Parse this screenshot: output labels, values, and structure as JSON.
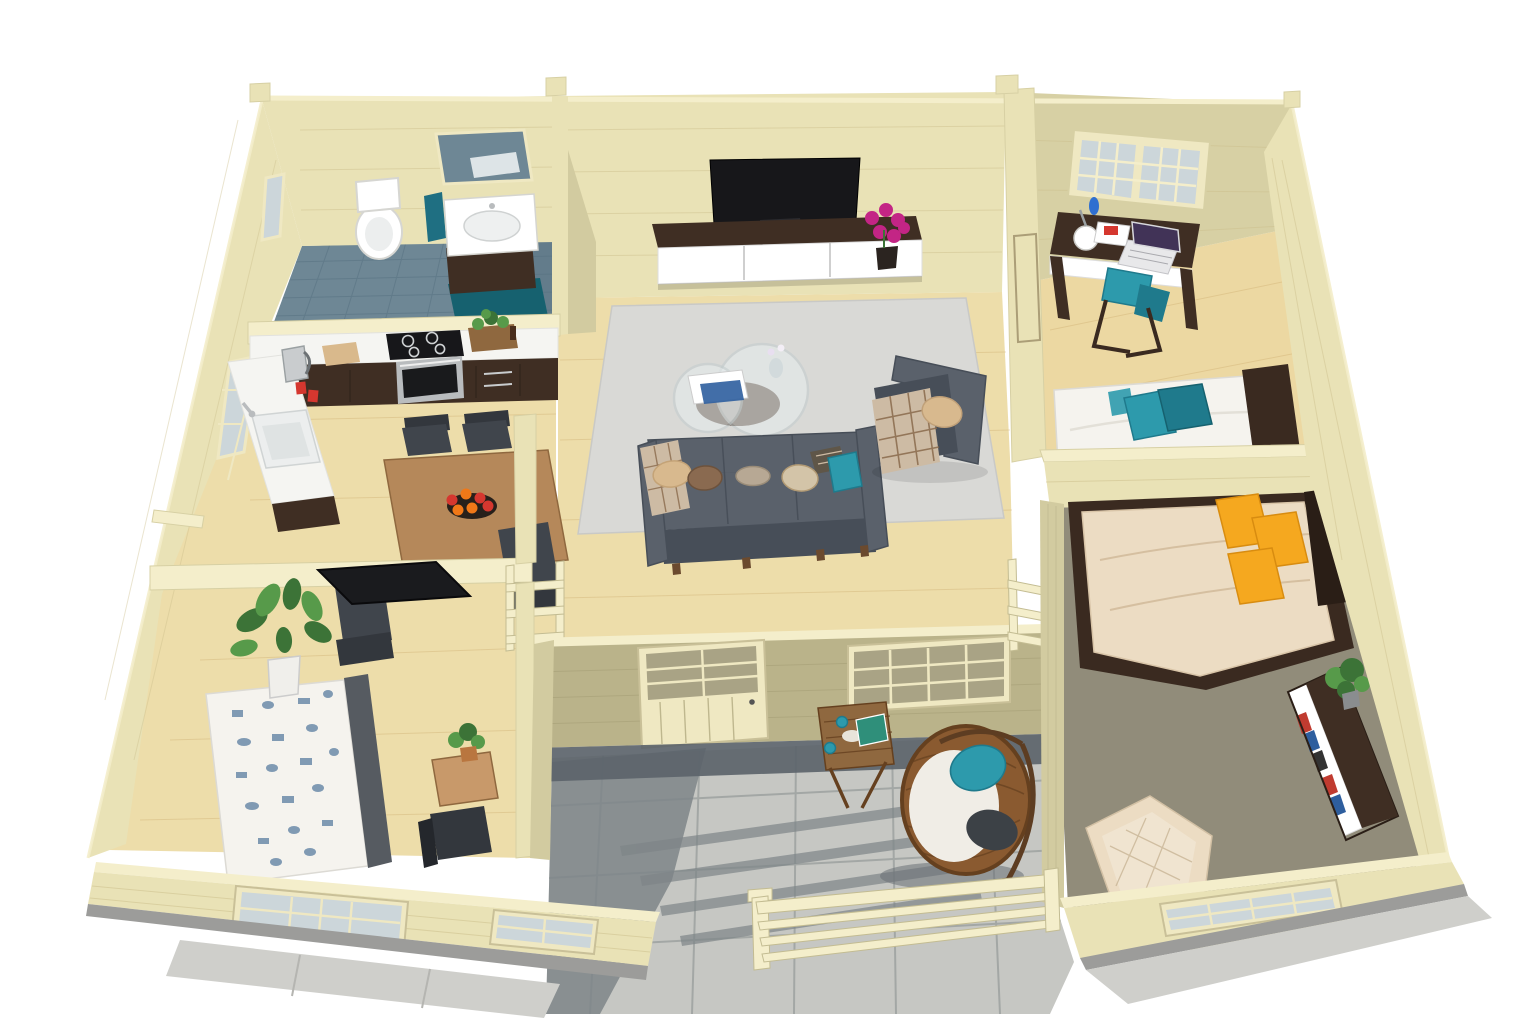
{
  "meta": {
    "title": "Log cabin interior — 3D bird's-eye floor-plan rendering",
    "view": "isometric top-down architectural visualization",
    "background": "#ffffff",
    "visible_text": "none"
  },
  "palette": {
    "bg": "#ffffff",
    "wall": "#e9e2b6",
    "wallBright": "#f4eecb",
    "wallShade": "#d7d0a4",
    "wallVert": "#d2cba0",
    "wallOlive": "#bab38a",
    "floor": "#edddaa",
    "floorWarm": "#ecd8a2",
    "tile": "#6e8795",
    "tileDark": "#587282",
    "rugTeal": "#16616f",
    "terr": "#c6c7c3",
    "terrJoint": "#9ba09e",
    "terrShadow": "#7e8588",
    "terrShadowDark": "#5c646b",
    "carpet": "#96907e",
    "counter": "#f5f5f2",
    "cabinet": "#3f2e23",
    "cabinetDark": "#2a1e16",
    "woodTable": "#b5885a",
    "woodSide": "#8f683f",
    "chairBlack": "#33373d",
    "sofa": "#5a616b",
    "sofaDark": "#474e58",
    "rugLiving": "#d9d9d6",
    "tv": "#17171a",
    "magenta": "#c32585",
    "plantG": "#3c7337",
    "plantL": "#579a4a",
    "teal": "#2d9aac",
    "tealDark": "#1f7a8c",
    "orange": "#f5a81f",
    "orangeD": "#d88c10",
    "duvet": "#ecdcc3",
    "bedWhite": "#f5f3ee",
    "patternBlue": "#5a7da0",
    "headboard": "#3a2a20",
    "frame": "#efe8c2",
    "glass": "#ccd6da",
    "glassOlive": "#a9a385",
    "foundation": "#9c9c9a",
    "concrete": "#cfcfcb",
    "metal": "#b9bcbe",
    "red": "#d5372f",
    "wicker": "#8a5a30",
    "wickerDark": "#65401f",
    "blanket": "#cdbba4",
    "blanketLine": "#8a6a4c",
    "pillowBeige": "#d8b98e",
    "pillowBrown": "#8a6a50",
    "pillowTaupe": "#b7a894",
    "white": "#ffffff",
    "bookRed": "#c03b30",
    "bookBlue": "#2e5e9e",
    "laptopScreen": "#413357"
  },
  "rooms": [
    {
      "id": "bathroom",
      "label": "Bathroom",
      "floor": "blue ceramic tile",
      "items": [
        "wall mirror",
        "toilet",
        "vanity washbasin with dark cabinet",
        "teal hand towel",
        "teal bath mat",
        "small side window"
      ]
    },
    {
      "id": "kitchen-dining",
      "label": "Kitchen / Dining",
      "floor": "light pine plank",
      "items": [
        "L-shaped white counter",
        "induction hob",
        "oven",
        "sink with faucet",
        "kettle",
        "cutting board",
        "red mugs",
        "herb planter box",
        "dining table",
        "four black chairs",
        "fruit bowl with apples",
        "black doormat",
        "tall side window"
      ]
    },
    {
      "id": "living-room",
      "label": "Living room",
      "floor": "light pine plank",
      "items": [
        "wall-mounted TV",
        "TV sideboard with white drawers",
        "magenta potted flower",
        "light gray area rug",
        "round glass coffee table",
        "magazines",
        "three-seat gray sofa",
        "scatter pillows",
        "gray armchair",
        "plaid blankets",
        "glazed terrace door",
        "terrace window",
        "interior railings"
      ]
    },
    {
      "id": "office-bedroom",
      "label": "Office / guest bedroom (top right)",
      "floor": "light pine plank",
      "items": [
        "six-pane double window",
        "dark wood desk with white drawer",
        "laptop",
        "round desk lamp",
        "magazine",
        "blue bottle",
        "teal stool chair",
        "single bed with white duvet",
        "teal pillows",
        "dark headboard"
      ]
    },
    {
      "id": "bedroom-right",
      "label": "Carpeted bedroom (right)",
      "floor": "gray-brown carpet",
      "items": [
        "double bed with beige duvet",
        "three orange pillows",
        "dark bed frame and headboard",
        "low bookshelf with books",
        "potted plant",
        "beige quilted armchair",
        "rear window"
      ]
    },
    {
      "id": "bedroom-left",
      "label": "Bedroom (lower left)",
      "floor": "light pine plank",
      "items": [
        "bed with blue toile-pattern duvet",
        "gray headboard",
        "large potted plant",
        "small wooden side table",
        "small potted plant",
        "dark chair",
        "double six-pane window"
      ]
    },
    {
      "id": "terrace",
      "label": "Terrace",
      "floor": "large gray stone tiles",
      "items": [
        "hanging wicker egg chair",
        "white seat cushion",
        "teal pillow",
        "gray throw",
        "folding slatted side table",
        "tea tray with teal mugs",
        "wooden slat railing",
        "cast shadows"
      ]
    }
  ],
  "structure": {
    "walls": "pale cream log-cabin planks",
    "window_glass": "cool gray-blue",
    "foundation": "gray concrete plinth",
    "roof_posts": "four corner/divider posts protruding above the top wall line"
  }
}
